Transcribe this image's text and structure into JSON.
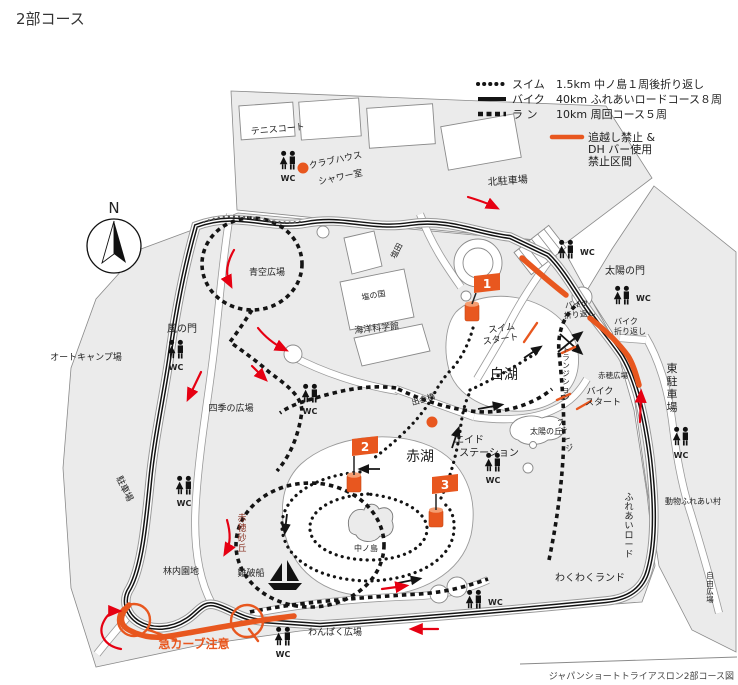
{
  "title": "2部コース",
  "caption": "ジャパンショートトライアスロン2部コース図",
  "compass": {
    "north": "N"
  },
  "legend": {
    "items": [
      {
        "type": "swim",
        "line": "dotted",
        "label": "スイム",
        "desc": "1.5km 中ノ島１周後折り返し"
      },
      {
        "type": "bike",
        "line": "solid",
        "label": "バイク",
        "desc": "40km ふれあいロードコース８周"
      },
      {
        "type": "run",
        "line": "square-dash",
        "label": "ラ ン",
        "desc": "10km 周回コース５周"
      }
    ],
    "restriction": {
      "color": "#e8571f",
      "lines": [
        "追越し禁止 &",
        "DH バー使用",
        "禁止区間"
      ]
    }
  },
  "markers": {
    "flags": [
      "1",
      "2",
      "3"
    ],
    "wc": "WC"
  },
  "labels": {
    "tennis_court": "テニスコート",
    "clubhouse": "クラブハウス",
    "shower_room": "シャワー室",
    "north_parking": "北駐車場",
    "east_parking": "東駐車場",
    "sun_gate": "太陽の門",
    "wind_gate": "風の門",
    "blue_sky_plaza": "青空広場",
    "auto_camp": "オートキャンプ場",
    "salt_field": "塩田",
    "salt_country": "塩の国",
    "marine_science_museum": "海洋科学館",
    "four_seasons_plaza": "四季の広場",
    "white_lake": "白湖",
    "red_lake": "赤湖",
    "nakanoshima": "中ノ島",
    "deai_bridge": "出会橋",
    "aid_station_1": "エイド",
    "aid_station_2": "ステーション",
    "sun_hill": "太陽の丘",
    "ako_plaza": "赤穂広場",
    "bike_start_1": "バイク",
    "bike_start_2": "スタート",
    "bike_turn_1": "バイク",
    "bike_turn_2": "折り返し",
    "swim_start_1": "スイム",
    "swim_start_2": "スタート",
    "forest_area": "林内園地",
    "shipwreck": "難破船",
    "wakuwaku_land": "わくわくランド",
    "animal_village": "動物ふれあい村",
    "wanpaku_plaza": "わんぱく広場",
    "sharp_curve_warning": "急カーブ注意",
    "ako_dune": "赤穂砂丘",
    "stage": "ステージ",
    "transition": "トランジション",
    "fureai_road": "ふれあいロード",
    "free_plaza": "自由広場",
    "parking": "駐車場"
  },
  "colors": {
    "accent_orange": "#e8571f",
    "arrow_red": "#e60012",
    "dune_dark_red": "#8a3324",
    "course_black": "#141414",
    "park_gray": "#ebebeb"
  }
}
